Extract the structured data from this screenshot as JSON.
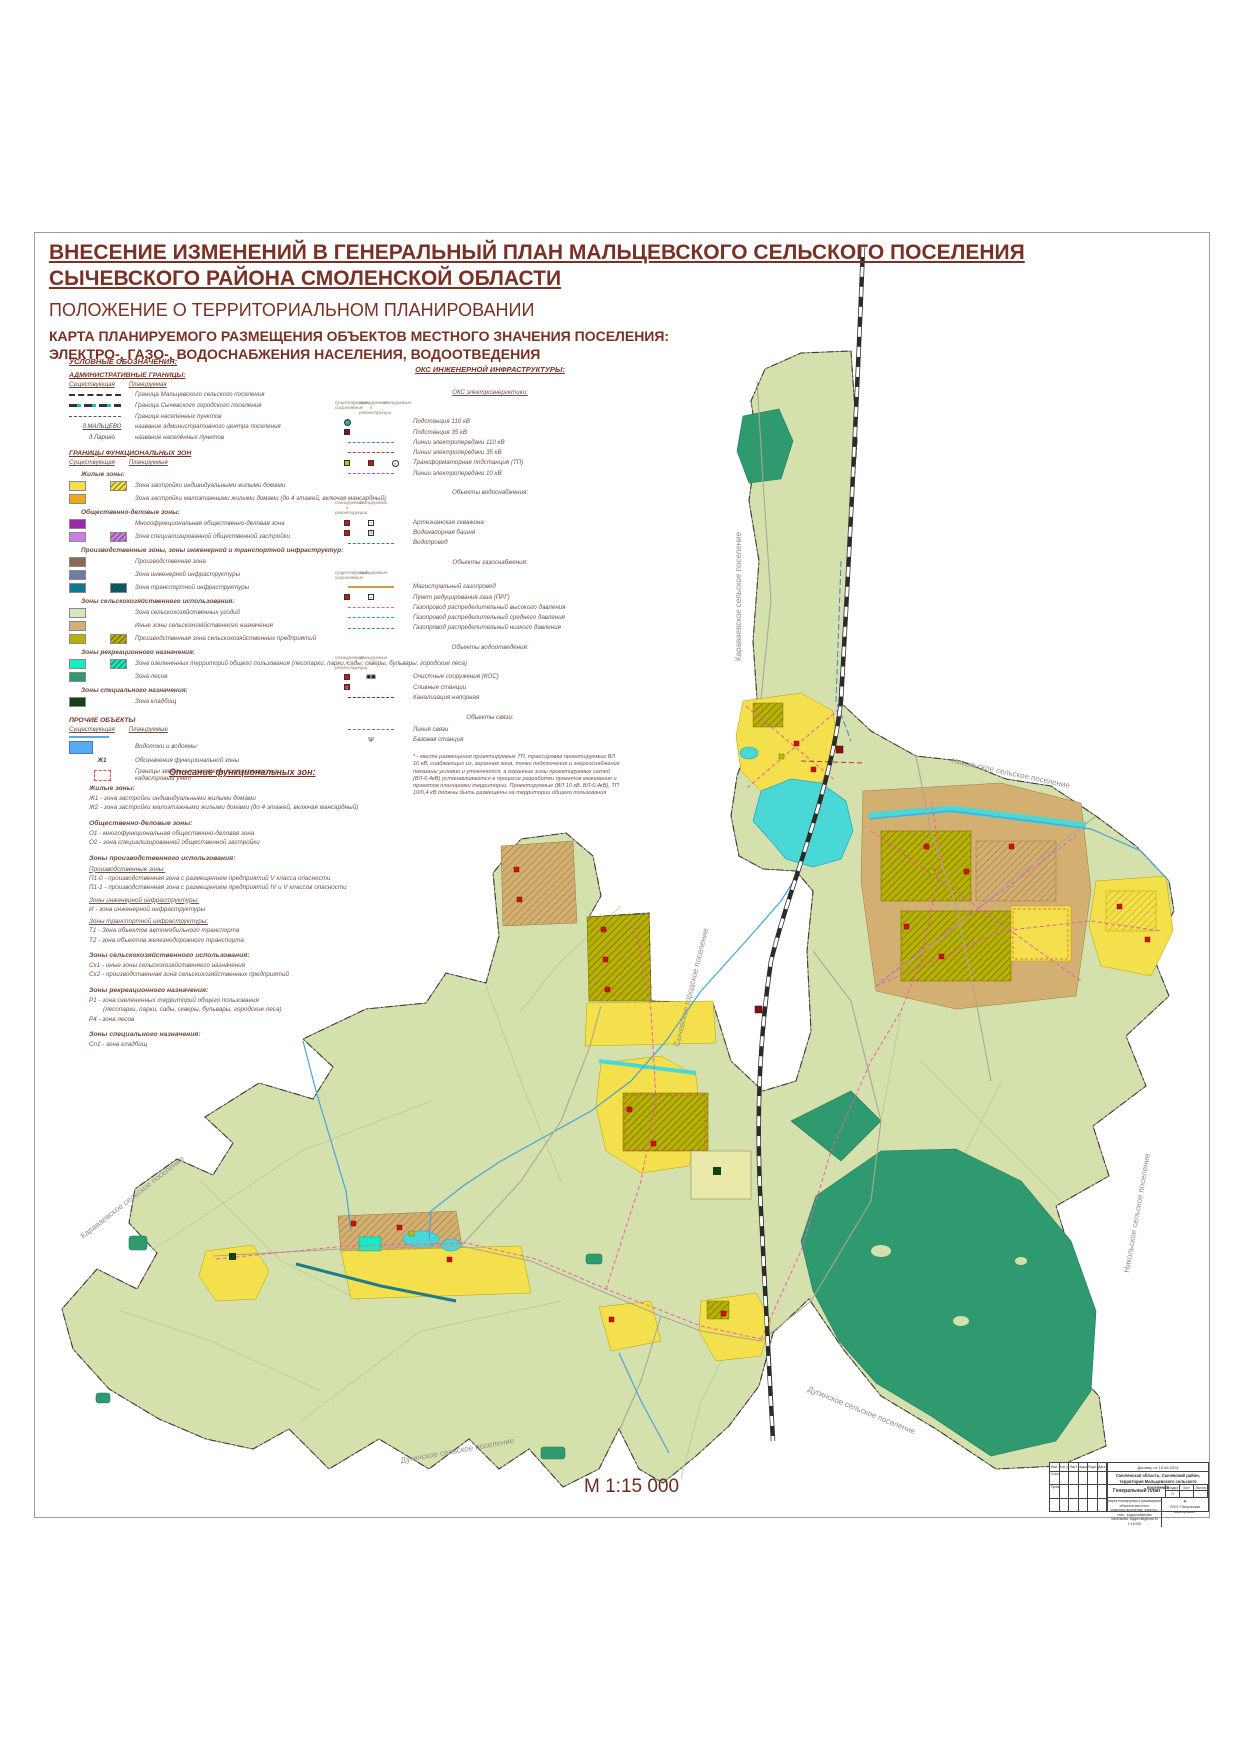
{
  "header": {
    "title1": "ВНЕСЕНИЕ ИЗМЕНЕНИЙ В ГЕНЕРАЛЬНЫЙ ПЛАН МАЛЬЦЕВСКОГО СЕЛЬСКОГО ПОСЕЛЕНИЯ",
    "title2": "СЫЧЕВСКОГО РАЙОНА СМОЛЕНСКОЙ ОБЛАСТИ",
    "subtitle": "ПОЛОЖЕНИЕ О ТЕРРИТОРИАЛЬНОМ ПЛАНИРОВАНИИ",
    "map_title1": "КАРТА ПЛАНИРУЕМОГО РАЗМЕЩЕНИЯ ОБЪЕКТОВ МЕСТНОГО ЗНАЧЕНИЯ ПОСЕЛЕНИЯ:",
    "map_title2": "ЭЛЕКТРО-, ГАЗО-, ВОДОСНАБЖЕНИЯ НАСЕЛЕНИЯ, ВОДООТВЕДЕНИЯ"
  },
  "leg": {
    "title": "УСЛОВНЫЕ ОБОЗНАЧЕНИЯ:",
    "admin_title": "АДМИНИСТРАТИВНЫЕ ГРАНИЦЫ:",
    "col_e": "Существующая",
    "col_p": "Планируемая",
    "col_p2": "Планируемые",
    "b1": "Граница  Мальцевского сельского поселения",
    "b2": "Граница  Сычевского городского поселения",
    "b3": "Граница населенных пунктов",
    "s1": "д.МАЛЬЦЕВО",
    "s1l": "название административного центра поселения",
    "s2": "д.Ларино",
    "s2l": "название населённых пунктов",
    "func_title": "ГРАНИЦЫ ФУНКЦИОНАЛЬНЫХ ЗОН",
    "g_zh": "Жилые зоны:",
    "zh1": "Зона застройки индивидуальными жилыми домами",
    "zh2": "Зона застройки малоэтажными жилыми домами (до 4 этажей, включая мансардный)",
    "g_od": "Общественно-деловые зоны:",
    "od1": "Многофункциональная общественно-деловая зона",
    "od2": "Зона специализированной общественной застройки",
    "g_pr": "Производственные зоны, зоны инженерной и транспортной инфраструктур:",
    "pr1": "Производственная зона",
    "pr2": "Зона инженерной инфраструктуры",
    "pr3": "Зона транспортной инфраструктуры",
    "g_sx": "Зоны сельскохозяйственного использования:",
    "sx1": "Зона сельскохозяйственных угодий",
    "sx2": "Иные зоны сельскохозяйственного назначения",
    "sx3": "Производственная зона сельскохозяйственных предприятий",
    "g_r": "Зоны рекреационного назначения:",
    "r1": "Зона озелененных территорий общего пользования (лесопарки, парки, сады, скверы, бульвары, городские леса)",
    "r2": "Зона лесов",
    "g_sp": "Зоны специального назначения:",
    "sp1": "Зона кладбищ",
    "other_title": "ПРОЧИЕ ОБЪЕКТЫ",
    "o1": "Водотоки и водоемы",
    "o2s": "Ж1",
    "o2": "Обозначения функциональной зоны",
    "o3": "Границы земельных участков, поставленных на кадастровый учет"
  },
  "eng": {
    "title": "ОКС ИНЖЕНЕРНОЙ ИНФРАСТРУКТУРЫ:",
    "s_el": "ОКС электроэнергетики:",
    "h_e": "существующие, сохраняемые",
    "h_p": "планируемые",
    "h_rec": "планируемые к реконструкции",
    "el1": "Подстанция 110 кВ",
    "el2": "Подстанция 35 кВ",
    "el3": "Линии электропередачи 110 кВ",
    "el4": "Линии электропередачи 35 кВ",
    "el5": "Трансформаторная подстанция (ТП)",
    "el6": "Линии электропередачи 10 кВ",
    "s_w": "Объекты водоснабжения:",
    "w1": "Артезианская скважина",
    "w2": "Водонапорная башня",
    "w3": "Водопровод",
    "s_g": "Объекты газоснабжения:",
    "g1": "Магистральный газопровод",
    "g2": "Пункт редуцирования газа (ПРГ)",
    "g3": "Газопровод распределительный высокого давления",
    "g4": "Газопровод распределительный среднего давления",
    "g5": "Газопровод распределительный низкого давления",
    "s_v": "Объекты водоотведения:",
    "v1": "Очистные сооружения (КОС)",
    "v2": "Сливные станции",
    "v3": "Канализация напорная",
    "s_c": "Объекты связи:",
    "c1": "Линия связи",
    "c2": "Базовая станция",
    "footnote": "* - места размещения проектируемых ТП, трассировка проектируемых ВЛ 10 кВ, снабжающих их, охранная зона, точки подключения и энергоснабжение показаны условно и уточняются, а охранные зоны проектируемых сетей (ВЛ-0,4кВ) устанавливаются в процессе разработки проектов межевания и проектов планировки территории. Проектируемые (ВЛ 10 кВ, ВЛ-0,4кВ), ТП 10/0,4 кВ должны быть размещены на территории общего пользования"
  },
  "desc": {
    "title": "Описание функциональных зон:",
    "g1": "Жилые зоны:",
    "i1": "Ж1 - зона застройки индивидуальными жилыми домами",
    "i2": "Ж2 - зона застройки малоэтажными жилыми домами (до 4 этажей, включая мансардный)",
    "g2": "Общественно-деловые зоны:",
    "i3": "О1 - многофункциональная общественно-деловая зона",
    "i4": "О2 - зона специализированной общественной застройки",
    "g3": "Зоны производственного использования:",
    "g3a": "Производственные зоны:",
    "i5": "П1-0 - производственная зона с размещением предприятий V класса опасности",
    "i6": "П1-1 - производственная зона с размещением предприятий IV и V классов опасности",
    "g3b": "Зоны инженерной инфраструктуры:",
    "i7": "И - зона инженерной инфраструктуры",
    "g3c": "Зоны транспортной инфраструктуры:",
    "i8": "Т1 - Зона объектов автомобильного транспорта",
    "i9": "Т2 - зона объектов железнодорожного транспорта",
    "g4": "Зоны сельскохозяйственного использования:",
    "i10": "Сх1 - иные зоны сельскохозяйственного назначения",
    "i11": "Сх2 - производственная зона сельскохозяйственных предприятий",
    "g5": "Зоны рекреационного назначения:",
    "i12": "Р1 - зона озелененных территорий общего пользования",
    "i12b": "(лесопарки, парки, сады, скверы, бульвары, городские леса)",
    "i13": "Р4 - зона лесов",
    "g6": "Зоны специального назначения:",
    "i14": "Сп1 - зона кладбищ"
  },
  "map": {
    "scale": "М 1:15 000",
    "lbl_karavaevo": "Караваевское сельское поселение",
    "lbl_nikolskoe": "Никольское сельское поселение",
    "lbl_sychevka": "Сычевское городское поселение",
    "lbl_duginskoe": "Дугинское сельское поселение"
  },
  "stamp": {
    "contract": "Договор от 10.06.2024",
    "location1": "Смоленская область, Сычевский район,",
    "location2": "территория Мальцевского сельского поселения",
    "doc": "Генеральный план",
    "h1": "Изм.",
    "h2": "Кол.уч",
    "h3": "Лист",
    "h4": "№док.",
    "h5": "Подп.",
    "h6": "Дата",
    "r1": "Составил",
    "r2": "Проверил",
    "stage_h": "Стадия",
    "sheet_h": "Лист",
    "sheets_h": "Листов",
    "stage": "П",
    "content1": "Карта планируемого размещения объектов местного",
    "content2": "значения поселения: электро-, газо-, водоснабжения",
    "content3": "населения, водоотведения  М 1:15 000",
    "org": "ООО «Творческая мастерская»"
  },
  "colors": {
    "title_text": "#7a3125",
    "territory": "#d5e1ad",
    "forest": "#2f9a70",
    "lake": "#49d8d6",
    "residential": "#f4e04c",
    "lowrise": "#f0a818",
    "business": "#9c27a8",
    "public": "#c97fe8",
    "industrial": "#8a6a52",
    "engineering": "#6f7ba0",
    "transport": "#11798e",
    "farmland": "#d9e5bd",
    "agri_other": "#d4af72",
    "agri_prod": "#b8b100",
    "recreation": "#12eec0",
    "cemetery": "#153f15",
    "waterbody": "#58aaf0",
    "railway": "#2b2b2b",
    "gas_line": "#ef5ab0",
    "tp_red": "#cc1111"
  }
}
